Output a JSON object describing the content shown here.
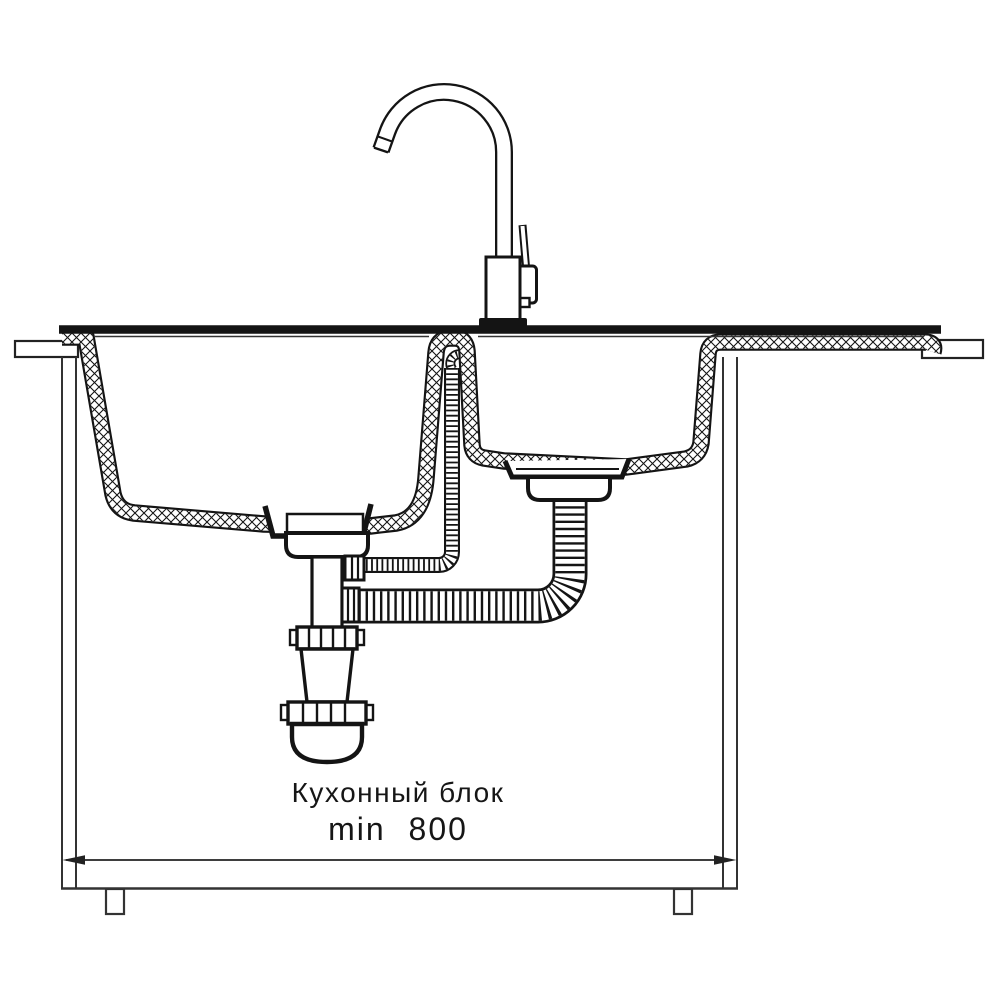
{
  "labels": {
    "caption": "Кухонный блок",
    "dimension": "min 800"
  },
  "colors": {
    "ink": "#141414",
    "background": "#ffffff"
  }
}
